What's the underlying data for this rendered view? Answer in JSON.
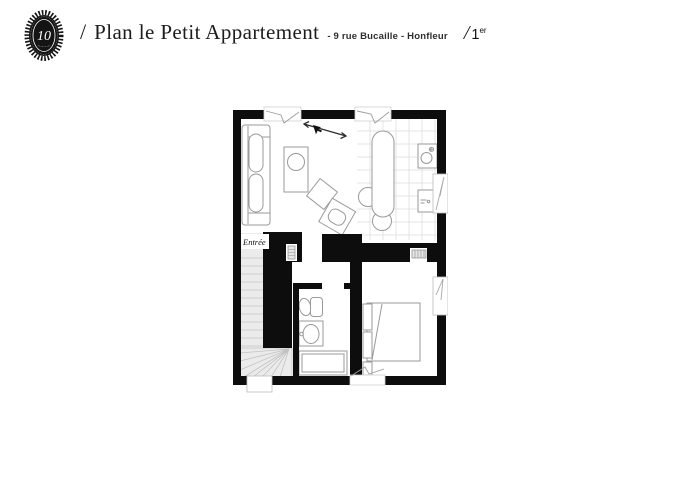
{
  "header": {
    "logo_monogram": "10",
    "slash": "/",
    "title": "Plan le Petit Appartement",
    "subtitle": "- 9 rue Bucaille - Honfleur",
    "floor": {
      "slash": "/",
      "number": "1",
      "suffix": "er"
    }
  },
  "plan": {
    "labels": {
      "entrance": "Entrée"
    },
    "colors": {
      "wall": "#0d0d0d",
      "stair_fill": "#ebebeb",
      "furniture_line": "#9a9a9a",
      "tile_line": "#dcdcdc",
      "background": "#ffffff"
    },
    "icons": {
      "cursor": "mouse-pointer-icon",
      "measure": "double-arrow-annotation-icon"
    }
  }
}
